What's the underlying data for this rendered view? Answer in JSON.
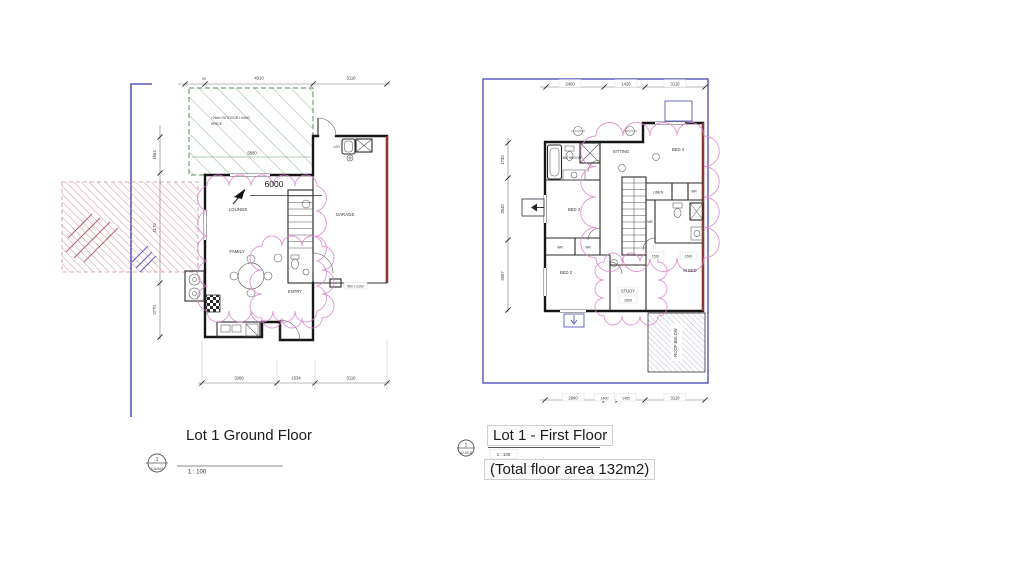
{
  "ground": {
    "title": "Lot 1 Ground Floor",
    "scale": "1 : 100",
    "tag_number": "1",
    "tag_sheet": "S-A2001",
    "north_dim": "6000",
    "outdoor_note_1": "+26m² OUTDOOR LIVING",
    "outdoor_note_2": "SPACE",
    "outdoor_dim": "5800",
    "garage_door_note": "900 x 2100",
    "rooms": {
      "lounge": "LOUNGE",
      "family": "FAMILY",
      "entry": "ENTRY",
      "garage": "GARAGE",
      "laundry": "LDY"
    },
    "dims_top": [
      "90",
      "4910",
      "3110"
    ],
    "dims_bottom": [
      "3266",
      "1534",
      "3110"
    ],
    "dims_left": [
      "1664",
      "4170",
      "2770"
    ]
  },
  "first": {
    "title": "Lot 1 - First Floor",
    "scale": "1 : 100",
    "area_note": "(Total floor area 132m2)",
    "tag_number": "1",
    "tag_sheet": "A2-02-A",
    "rooms": {
      "bathroom": "BATHROOM",
      "sitting": "SITTING",
      "bed4": "BED 4",
      "bed3": "BED 3",
      "bed2": "BED 2",
      "linen": "LINEN",
      "wr": "WR",
      "mbed": "M BED",
      "study": "STUDY",
      "roof_below": "ROOF BELOW"
    },
    "open_dims": {
      "study": "1600",
      "hall": "1520",
      "hall2": "1600"
    },
    "dims_top": [
      "2400",
      "1426",
      "3110"
    ],
    "dims_bottom": [
      "2900",
      "1400",
      "1455",
      "3110"
    ],
    "dims_left": [
      "1730",
      "2640",
      "2667"
    ]
  }
}
